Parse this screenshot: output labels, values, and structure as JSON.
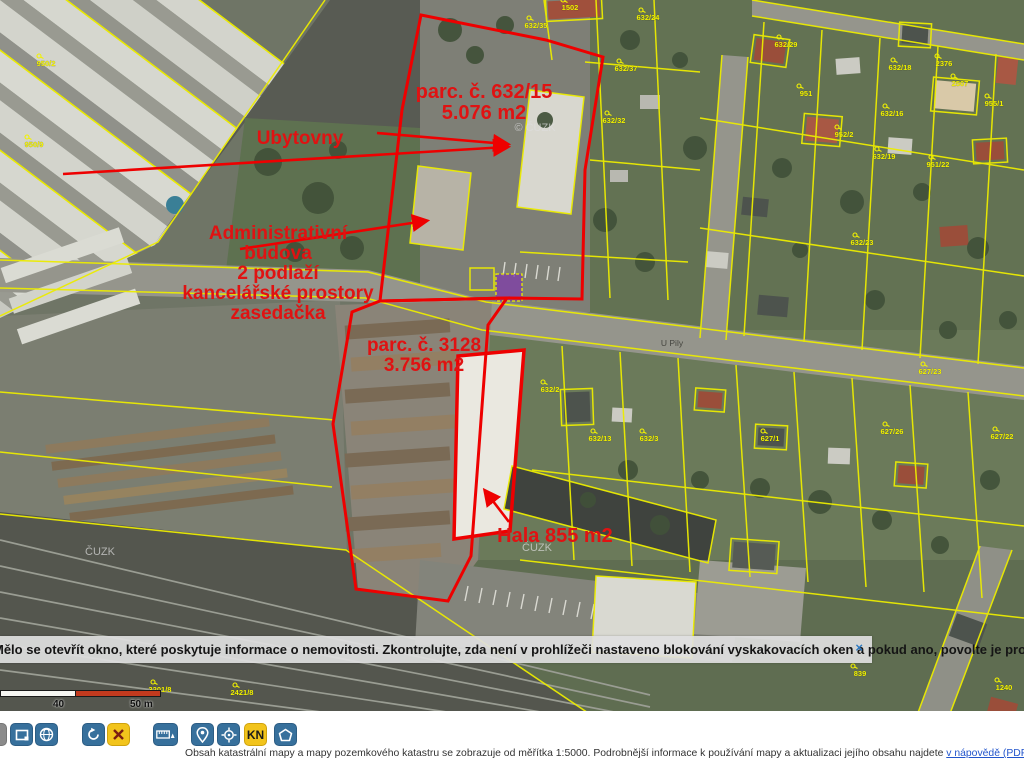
{
  "app": {
    "name": "Nahlížení do katastru nemovitostí – mapa"
  },
  "colors": {
    "cadastral_line": "#ecec00",
    "highlight_red": "#ee0000",
    "toolbar_blue": "#37709c",
    "toolbar_yellow": "#f2c41c",
    "scalebar_red": "#c23a1e",
    "link_blue": "#2255cc",
    "warning_red": "#e00000"
  },
  "map": {
    "annotations": [
      {
        "id": "parcel-632-15",
        "lines": [
          "parc. č. 632/15",
          "5.076 m2"
        ],
        "x": 484,
        "y": 82,
        "size": 20
      },
      {
        "id": "ubytovny",
        "lines": [
          "Ubytovny"
        ],
        "x": 300,
        "y": 129,
        "size": 19
      },
      {
        "id": "admin-budova",
        "lines": [
          "Administrativní",
          "budova",
          "2 podlaží",
          "kancelářské prostory",
          "zasedačka"
        ],
        "x": 278,
        "y": 224,
        "size": 19
      },
      {
        "id": "parcel-3128",
        "lines": [
          "parc. č. 3128",
          "3.756 m2"
        ],
        "x": 424,
        "y": 336,
        "size": 19
      },
      {
        "id": "hala",
        "lines": [
          "Hala 855 m2"
        ],
        "x": 555,
        "y": 526,
        "size": 20
      }
    ],
    "parcel_labels": [
      {
        "t": "1502",
        "x": 570,
        "y": 10
      },
      {
        "t": "632/35",
        "x": 536,
        "y": 28
      },
      {
        "t": "632/24",
        "x": 648,
        "y": 20
      },
      {
        "t": "632/37",
        "x": 626,
        "y": 71
      },
      {
        "t": "632/32",
        "x": 614,
        "y": 123
      },
      {
        "t": "632/29",
        "x": 786,
        "y": 47
      },
      {
        "t": "632/18",
        "x": 900,
        "y": 70
      },
      {
        "t": "2376",
        "x": 944,
        "y": 66
      },
      {
        "t": "2507",
        "x": 960,
        "y": 86
      },
      {
        "t": "951",
        "x": 806,
        "y": 96
      },
      {
        "t": "955/1",
        "x": 994,
        "y": 106
      },
      {
        "t": "632/16",
        "x": 892,
        "y": 116
      },
      {
        "t": "952/2",
        "x": 844,
        "y": 137
      },
      {
        "t": "632/19",
        "x": 884,
        "y": 159
      },
      {
        "t": "951/22",
        "x": 938,
        "y": 167
      },
      {
        "t": "632/23",
        "x": 862,
        "y": 245
      },
      {
        "t": "950/2",
        "x": 46,
        "y": 66
      },
      {
        "t": "950/9",
        "x": 34,
        "y": 147
      },
      {
        "t": "627/23",
        "x": 930,
        "y": 374
      },
      {
        "t": "627/26",
        "x": 892,
        "y": 434
      },
      {
        "t": "627/22",
        "x": 1002,
        "y": 439
      },
      {
        "t": "632/2",
        "x": 550,
        "y": 392
      },
      {
        "t": "632/13",
        "x": 600,
        "y": 441
      },
      {
        "t": "632/3",
        "x": 649,
        "y": 441
      },
      {
        "t": "627/1",
        "x": 770,
        "y": 441
      },
      {
        "t": "2421/8",
        "x": 242,
        "y": 695
      },
      {
        "t": "3201/8",
        "x": 160,
        "y": 692
      },
      {
        "t": "839",
        "x": 860,
        "y": 676
      },
      {
        "t": "1240",
        "x": 1004,
        "y": 690
      }
    ],
    "watermarks": [
      {
        "t": "© ČUZK",
        "x": 535,
        "y": 131
      },
      {
        "t": "ČUZK",
        "x": 537,
        "y": 551
      },
      {
        "t": "ČUZK",
        "x": 100,
        "y": 555
      }
    ],
    "street_labels": [
      {
        "t": "U Pily",
        "x": 672,
        "y": 346
      }
    ]
  },
  "popup": {
    "message": "Mělo se otevřít okno, které poskytuje informace o nemovitosti. Zkontrolujte, zda není v prohlížeči nastaveno blokování vyskakovacích oken a pokud ano, povolte je pro tuto stránku.",
    "close_label": "×"
  },
  "scalebar": {
    "labels": [
      "40",
      "50 m"
    ]
  },
  "toolbar": {
    "buttons": [
      {
        "name": "previous-partial",
        "icon": "partial-icon"
      },
      {
        "name": "select-extent",
        "icon": "selection-rect-icon"
      },
      {
        "name": "overview-globe",
        "icon": "globe-icon"
      },
      {
        "name": "refresh",
        "icon": "refresh-icon"
      },
      {
        "name": "close-tool",
        "icon": "x-icon"
      },
      {
        "name": "measure",
        "icon": "ruler-icon"
      },
      {
        "name": "gps-locate",
        "icon": "location-pin-icon"
      },
      {
        "name": "center-view",
        "icon": "crosshair-icon"
      },
      {
        "name": "kn-layers",
        "label": "KN"
      },
      {
        "name": "polygon-info",
        "icon": "pentagon-icon"
      }
    ],
    "kn_label": "KN"
  },
  "statusbar": {
    "text_left": "Obsah katastrální mapy a mapy pozemkového katastru se zobrazuje od měřítka 1:5000. Podrobnější informace k používání mapy a aktualizaci jejího obsahu najdete ",
    "link": "v nápovědě (PDF)",
    "separator": ". ",
    "warning": "Veškeré zjištěné hodnoty souřadnic a délek NELZE využívat"
  }
}
